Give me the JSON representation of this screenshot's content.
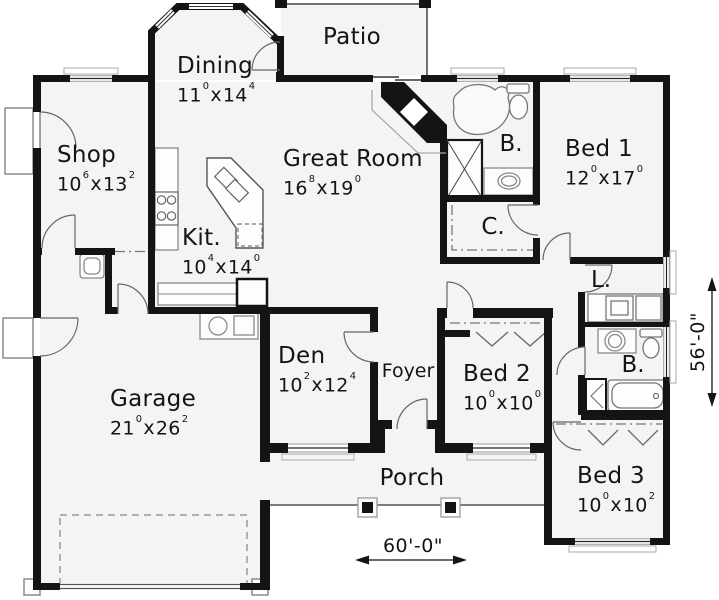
{
  "plan_title": "Single level house plan",
  "rooms": {
    "patio": {
      "name": "Patio"
    },
    "dining": {
      "name": "Dining",
      "d1": "11",
      "s1": "0",
      "d2": "14",
      "s2": "4"
    },
    "shop": {
      "name": "Shop",
      "d1": "10",
      "s1": "6",
      "d2": "13",
      "s2": "2"
    },
    "great_room": {
      "name": "Great Room",
      "d1": "16",
      "s1": "8",
      "d2": "19",
      "s2": "0"
    },
    "kitchen": {
      "name": "Kit.",
      "d1": "10",
      "s1": "4",
      "d2": "14",
      "s2": "0"
    },
    "bath_master": {
      "name": "B."
    },
    "bed1": {
      "name": "Bed 1",
      "d1": "12",
      "s1": "0",
      "d2": "17",
      "s2": "0"
    },
    "closet": {
      "name": "C."
    },
    "laundry": {
      "name": "L."
    },
    "den": {
      "name": "Den",
      "d1": "10",
      "s1": "2",
      "d2": "12",
      "s2": "4"
    },
    "foyer": {
      "name": "Foyer"
    },
    "bed2": {
      "name": "Bed 2",
      "d1": "10",
      "s1": "0",
      "d2": "10",
      "s2": "0"
    },
    "bath_hall": {
      "name": "B."
    },
    "garage": {
      "name": "Garage",
      "d1": "21",
      "s1": "0",
      "d2": "26",
      "s2": "2"
    },
    "porch": {
      "name": "Porch"
    },
    "bed3": {
      "name": "Bed 3",
      "d1": "10",
      "s1": "0",
      "d2": "10",
      "s2": "2"
    }
  },
  "sep": "x",
  "dimensions": {
    "width": "60'-0\"",
    "height": "56'-0\""
  },
  "colors": {
    "wall": "#141414",
    "floor": "#f4f4f4",
    "thin_line": "#555555",
    "fixture": "#8a8a8a"
  }
}
